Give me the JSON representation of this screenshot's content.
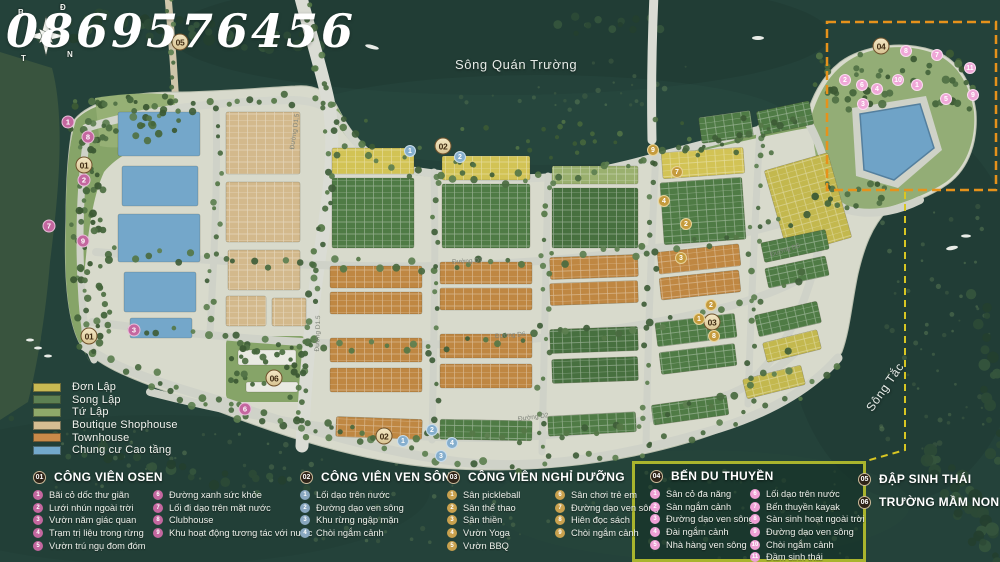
{
  "watermark": "0869576456",
  "compass": {
    "d": "Đ",
    "b": "B",
    "t": "T",
    "n": "N"
  },
  "water_labels": {
    "river_top": "Sông Quán Trường",
    "river_right": "Sông Tắc"
  },
  "streets": [
    {
      "label": "Đường D1.5",
      "x": 277,
      "y": 128,
      "rot": -82
    },
    {
      "label": "Đường D1.5",
      "x": 300,
      "y": 330,
      "rot": -88
    },
    {
      "label": "Đường D7",
      "x": 452,
      "y": 258,
      "rot": -3
    },
    {
      "label": "Đường D6",
      "x": 495,
      "y": 332,
      "rot": -4
    },
    {
      "label": "Đường D2",
      "x": 518,
      "y": 414,
      "rot": -7
    },
    {
      "label": "Đường D6",
      "x": 770,
      "y": 247,
      "rot": -18
    }
  ],
  "map_badges": [
    {
      "t": "05",
      "k": "zone",
      "x": 180,
      "y": 42
    },
    {
      "t": "01",
      "k": "zone",
      "x": 84,
      "y": 165
    },
    {
      "t": "02",
      "k": "zone",
      "x": 443,
      "y": 146
    },
    {
      "t": "01",
      "k": "zone",
      "x": 89,
      "y": 336
    },
    {
      "t": "06",
      "k": "zone",
      "x": 274,
      "y": 378
    },
    {
      "t": "02",
      "k": "zone",
      "x": 384,
      "y": 436
    },
    {
      "t": "03",
      "k": "zone",
      "x": 712,
      "y": 322
    },
    {
      "t": "04",
      "k": "zone",
      "x": 881,
      "y": 46
    },
    {
      "t": "1",
      "k": "pink",
      "x": 68,
      "y": 122
    },
    {
      "t": "8",
      "k": "pink",
      "x": 88,
      "y": 137
    },
    {
      "t": "2",
      "k": "pink",
      "x": 84,
      "y": 180
    },
    {
      "t": "7",
      "k": "pink",
      "x": 49,
      "y": 226
    },
    {
      "t": "9",
      "k": "pink",
      "x": 83,
      "y": 241
    },
    {
      "t": "3",
      "k": "pink",
      "x": 134,
      "y": 330
    },
    {
      "t": "6",
      "k": "pink",
      "x": 245,
      "y": 409
    },
    {
      "t": "1",
      "k": "blue",
      "x": 410,
      "y": 151
    },
    {
      "t": "2",
      "k": "blue",
      "x": 460,
      "y": 157
    },
    {
      "t": "1",
      "k": "blue",
      "x": 403,
      "y": 441
    },
    {
      "t": "2",
      "k": "blue",
      "x": 432,
      "y": 430
    },
    {
      "t": "4",
      "k": "blue",
      "x": 452,
      "y": 443
    },
    {
      "t": "3",
      "k": "blue",
      "x": 441,
      "y": 456
    },
    {
      "t": "9",
      "k": "gold",
      "x": 653,
      "y": 150
    },
    {
      "t": "7",
      "k": "gold",
      "x": 677,
      "y": 172
    },
    {
      "t": "4",
      "k": "gold",
      "x": 664,
      "y": 201
    },
    {
      "t": "2",
      "k": "gold",
      "x": 686,
      "y": 224
    },
    {
      "t": "3",
      "k": "gold",
      "x": 681,
      "y": 258
    },
    {
      "t": "2",
      "k": "gold",
      "x": 711,
      "y": 305
    },
    {
      "t": "1",
      "k": "gold",
      "x": 699,
      "y": 319
    },
    {
      "t": "8",
      "k": "gold",
      "x": 714,
      "y": 336
    },
    {
      "t": "1",
      "k": "rose",
      "x": 917,
      "y": 85
    },
    {
      "t": "2",
      "k": "rose",
      "x": 845,
      "y": 80
    },
    {
      "t": "3",
      "k": "rose",
      "x": 863,
      "y": 104
    },
    {
      "t": "4",
      "k": "rose",
      "x": 877,
      "y": 89
    },
    {
      "t": "5",
      "k": "rose",
      "x": 946,
      "y": 99
    },
    {
      "t": "6",
      "k": "rose",
      "x": 862,
      "y": 85
    },
    {
      "t": "7",
      "k": "rose",
      "x": 937,
      "y": 55
    },
    {
      "t": "8",
      "k": "rose",
      "x": 906,
      "y": 51
    },
    {
      "t": "9",
      "k": "rose",
      "x": 973,
      "y": 95
    },
    {
      "t": "10",
      "k": "rose",
      "x": 898,
      "y": 80
    },
    {
      "t": "11",
      "k": "rose",
      "x": 970,
      "y": 68
    }
  ],
  "legend_swatches": [
    {
      "label": "Đơn Lập",
      "color": "#c9b952"
    },
    {
      "label": "Song Lập",
      "color": "#5d8052"
    },
    {
      "label": "Tứ Lập",
      "color": "#8fa96a"
    },
    {
      "label": "Boutique Shophouse",
      "color": "#d6bd92"
    },
    {
      "label": "Townhouse",
      "color": "#c98a49"
    },
    {
      "label": "Chung cư Cao tầng",
      "color": "#73a9cc"
    }
  ],
  "legend_sections": [
    {
      "num": "01",
      "title": "CÔNG VIÊN OSEN",
      "accent": "#c4679f",
      "columns": [
        [
          {
            "n": "1",
            "label": "Bãi cỏ dốc thư giãn"
          },
          {
            "n": "2",
            "label": "Lưới nhún ngoài trời"
          },
          {
            "n": "3",
            "label": "Vườn năm giác quan"
          },
          {
            "n": "4",
            "label": "Trạm trị liệu trong rừng"
          },
          {
            "n": "5",
            "label": "Vườn trú ngụ đom đóm"
          }
        ],
        [
          {
            "n": "6",
            "label": "Đường xanh sức khỏe"
          },
          {
            "n": "7",
            "label": "Lối đi dạo trên mặt nước"
          },
          {
            "n": "8",
            "label": "Clubhouse"
          },
          {
            "n": "9",
            "label": "Khu hoạt động tương tác với nước"
          }
        ]
      ]
    },
    {
      "num": "02",
      "title": "CÔNG VIÊN VEN SÔNG",
      "accent": "#89a7c0",
      "columns": [
        [
          {
            "n": "1",
            "label": "Lối dạo trên nước"
          },
          {
            "n": "2",
            "label": "Đường dạo ven sông"
          },
          {
            "n": "3",
            "label": "Khu rừng ngập mặn"
          },
          {
            "n": "4",
            "label": "Chòi ngắm cảnh"
          }
        ]
      ]
    },
    {
      "num": "03",
      "title": "CÔNG VIÊN NGHỈ DƯỠNG",
      "accent": "#c9a14e",
      "columns": [
        [
          {
            "n": "1",
            "label": "Sân pickleball"
          },
          {
            "n": "2",
            "label": "Sân thể thao"
          },
          {
            "n": "3",
            "label": "Sân thiền"
          },
          {
            "n": "4",
            "label": "Vườn Yoga"
          },
          {
            "n": "5",
            "label": "Vườn BBQ"
          }
        ],
        [
          {
            "n": "6",
            "label": "Sân chơi trẻ em"
          },
          {
            "n": "7",
            "label": "Đường dạo ven sông"
          },
          {
            "n": "8",
            "label": "Hiên đọc sách"
          },
          {
            "n": "9",
            "label": "Chòi ngắm cảnh"
          }
        ]
      ]
    },
    {
      "num": "04",
      "title": "BẾN DU THUYỀN",
      "accent": "#efa0d5",
      "columns": [
        [
          {
            "n": "1",
            "label": "Sân cỏ đa năng"
          },
          {
            "n": "2",
            "label": "Sàn ngắm cảnh"
          },
          {
            "n": "3",
            "label": "Đường dạo ven sông"
          },
          {
            "n": "4",
            "label": "Đài ngắm cảnh"
          },
          {
            "n": "5",
            "label": "Nhà hàng ven sông"
          }
        ],
        [
          {
            "n": "6",
            "label": "Lối dạo trên nước"
          },
          {
            "n": "7",
            "label": "Bến thuyền kayak"
          },
          {
            "n": "8",
            "label": "Sàn sinh hoạt ngoài trời"
          },
          {
            "n": "9",
            "label": "Đường dạo ven sông"
          },
          {
            "n": "10",
            "label": "Chòi ngắm cảnh"
          },
          {
            "n": "11",
            "label": "Đầm sinh thái"
          }
        ]
      ]
    },
    {
      "num": "05",
      "title": "ĐẬP SINH THÁI",
      "accent": "",
      "columns": []
    },
    {
      "num": "06",
      "title": "TRƯỜNG MẦM NON",
      "accent": "",
      "columns": []
    }
  ]
}
